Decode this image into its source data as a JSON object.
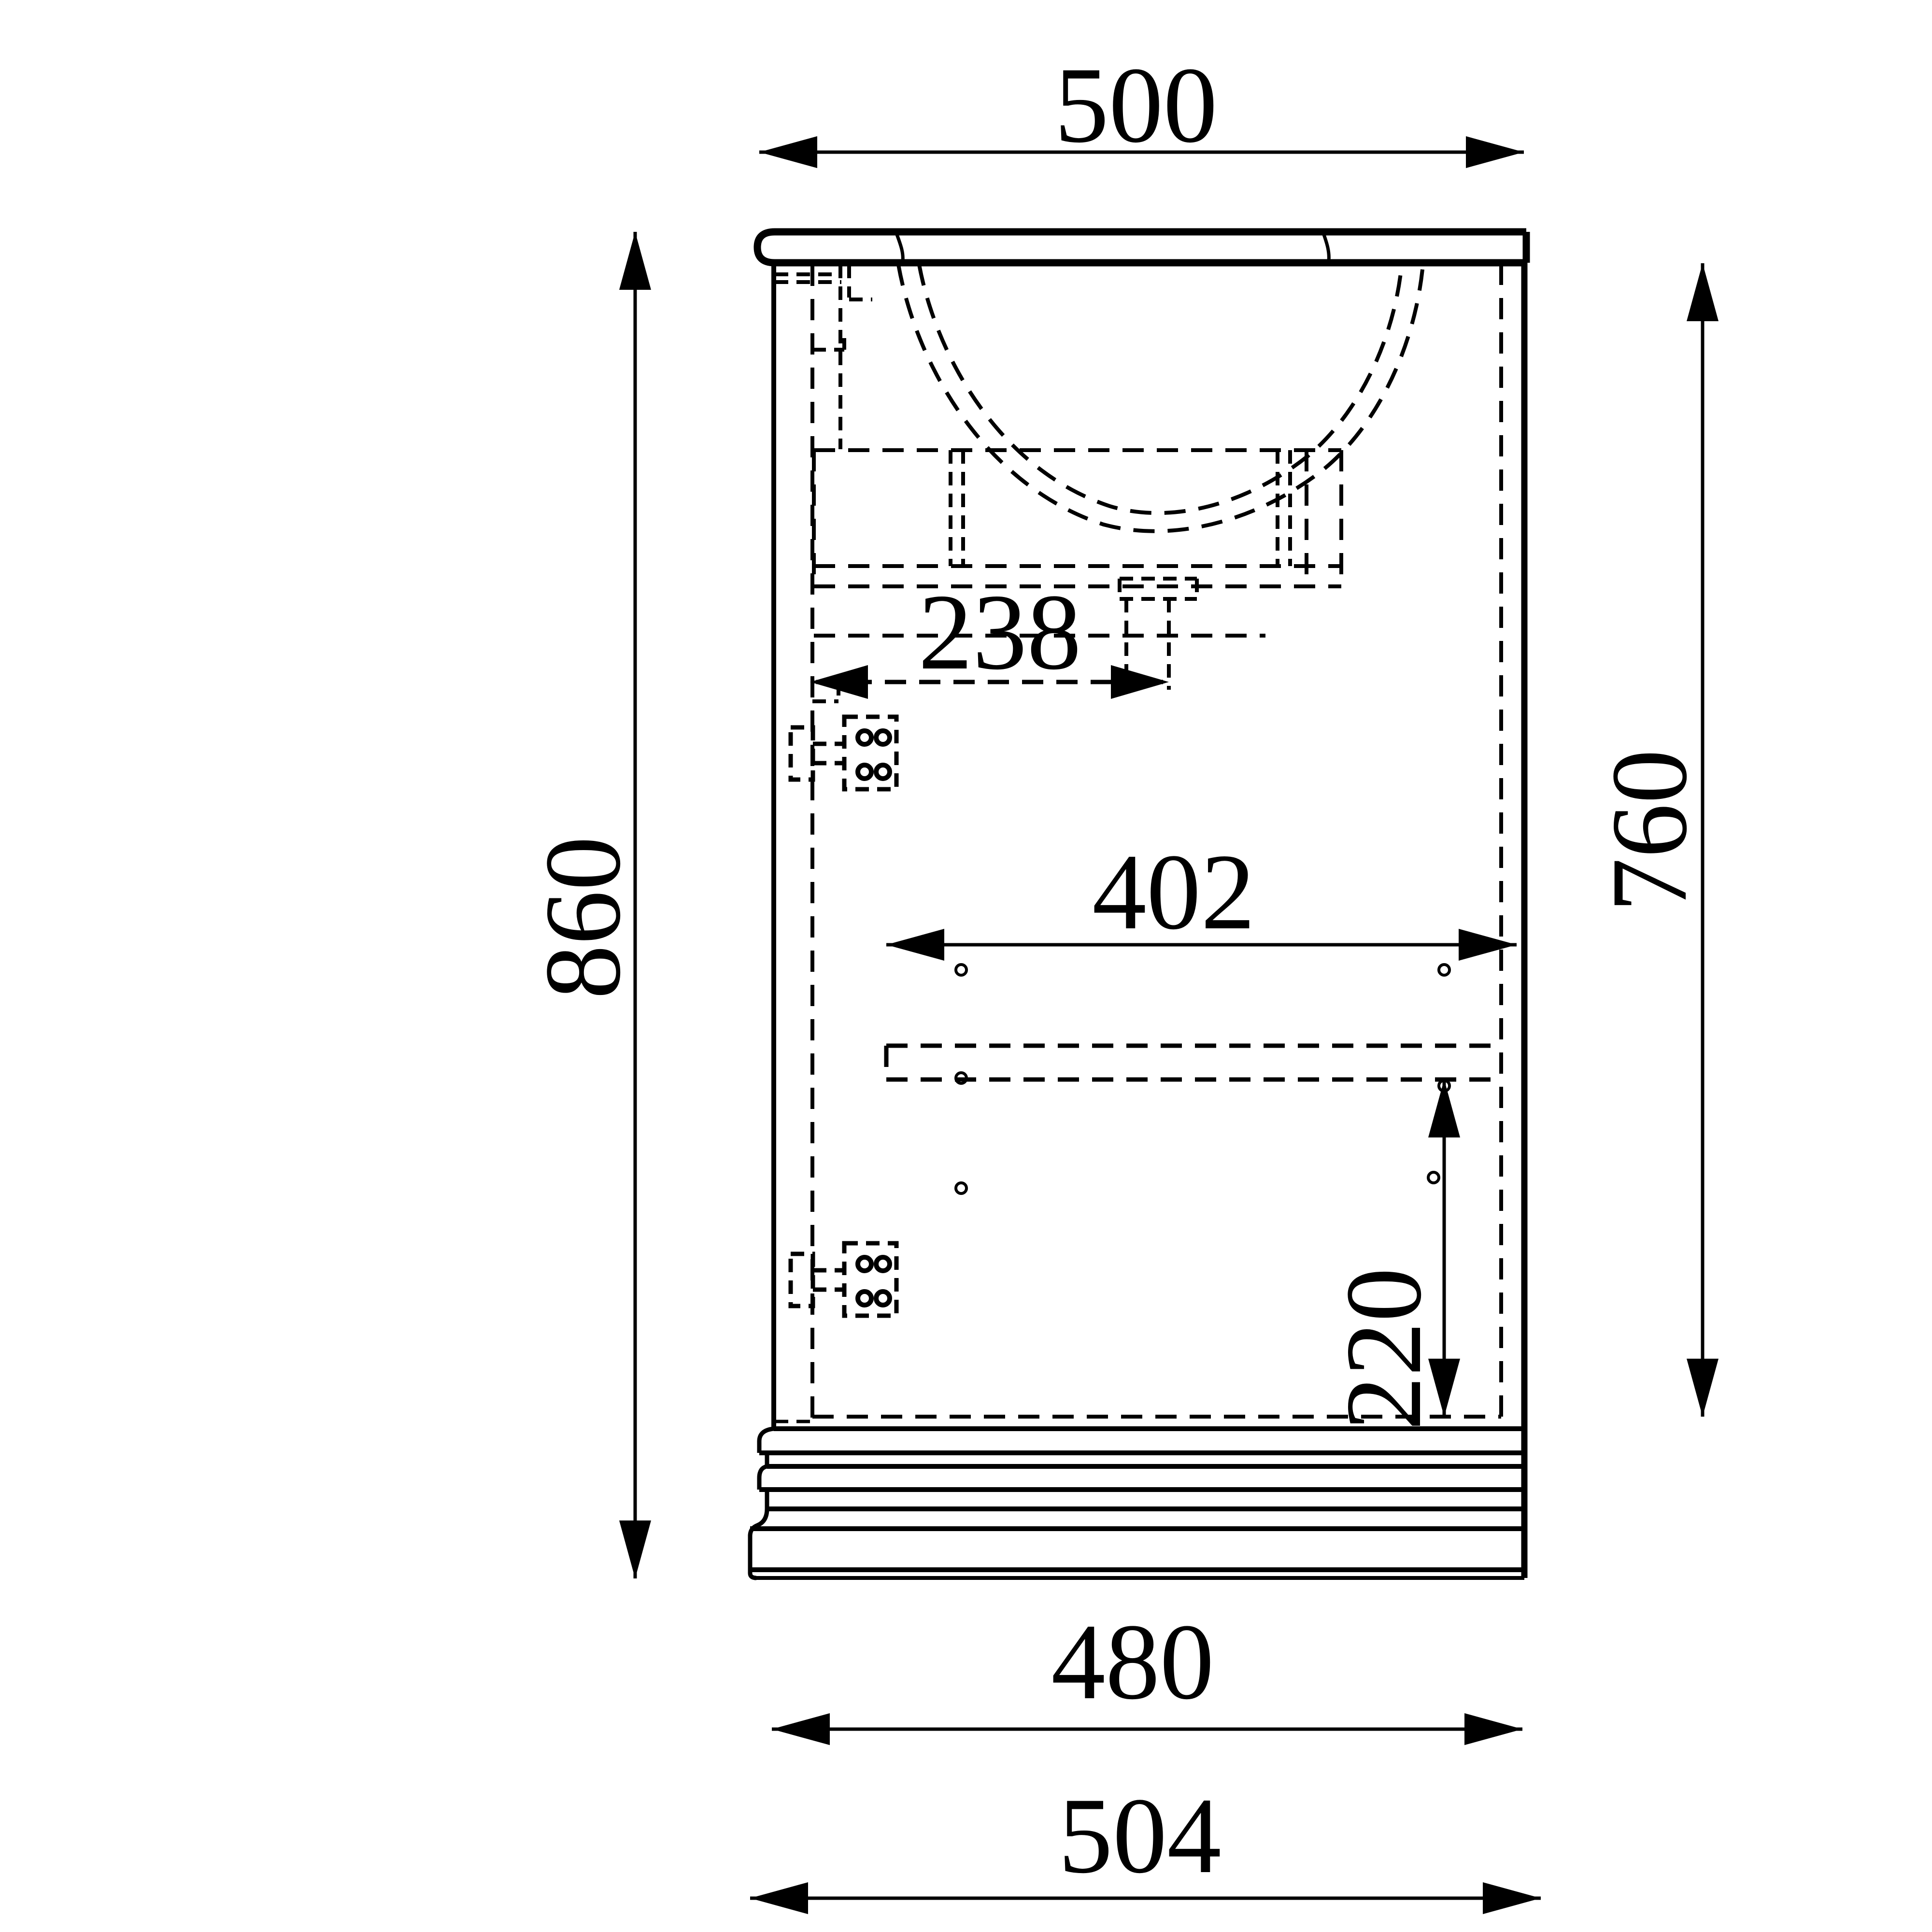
{
  "title": "Bathroom vanity cabinet side-section technical drawing",
  "units": "mm",
  "colors": {
    "line": "#000000",
    "background": "#ffffff"
  },
  "dimensions": {
    "top_width": {
      "value": "500",
      "orientation": "horizontal",
      "line_style": "solid",
      "measures": "countertop width"
    },
    "overall_height": {
      "value": "860",
      "orientation": "vertical",
      "line_style": "solid",
      "measures": "overall height with plinth"
    },
    "carcass_height": {
      "value": "760",
      "orientation": "vertical",
      "line_style": "solid",
      "measures": "carcass height below countertop"
    },
    "drain_offset": {
      "value": "238",
      "orientation": "horizontal",
      "line_style": "dashed",
      "measures": "front edge to drain pipe"
    },
    "interior_width": {
      "value": "402",
      "orientation": "horizontal",
      "line_style": "solid",
      "measures": "interior shelf width"
    },
    "bottom_clearance": {
      "value": "220",
      "orientation": "vertical",
      "line_style": "solid",
      "measures": "shelf to cabinet bottom"
    },
    "carcass_width": {
      "value": "480",
      "orientation": "horizontal",
      "line_style": "solid",
      "measures": "carcass width"
    },
    "plinth_width": {
      "value": "504",
      "orientation": "horizontal",
      "line_style": "solid",
      "measures": "plinth width"
    }
  },
  "parts": [
    "countertop",
    "left-side-panel",
    "right-side-panel",
    "door-hidden-edge",
    "wash-basin-bowl",
    "basin-mounting-frame",
    "drain-pipe",
    "hinge-top",
    "hinge-bottom",
    "shelf",
    "screw-holes",
    "plinth"
  ]
}
